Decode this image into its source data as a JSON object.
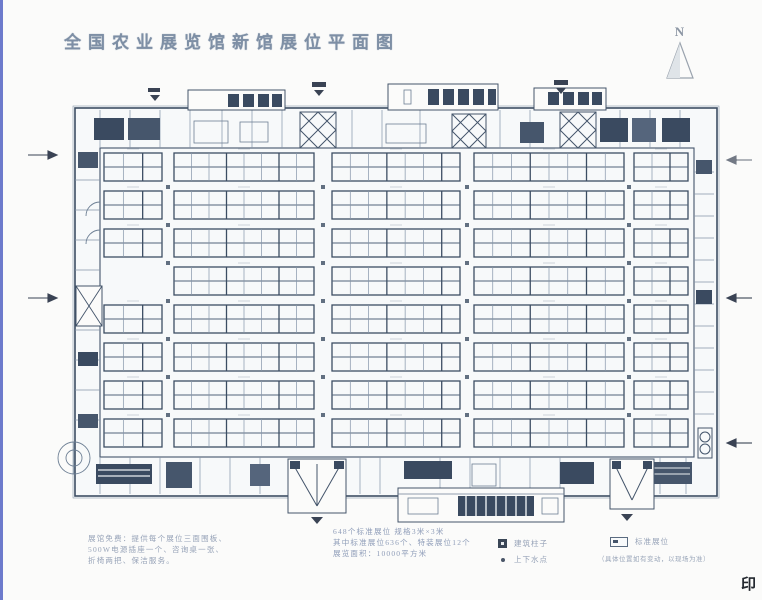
{
  "title": "全国农业展览馆新馆展位平面图",
  "compass": {
    "label": "N"
  },
  "stamp": "印",
  "notes_left": {
    "lines": [
      "展馆免费：提供每个展位三面围板、",
      "500W电源插座一个、咨询桌一张、",
      "折椅两把、保洁服务。"
    ]
  },
  "notes_center": {
    "lines": [
      "648个标准展位 规格3米×3米",
      "其中标准展位636个、特装展位12个",
      "展览面积：10000平方米"
    ]
  },
  "legend": {
    "items": [
      {
        "icon": "column-icon",
        "label": "建筑柱子"
      },
      {
        "icon": "water-point-icon",
        "label": "上下水点"
      },
      {
        "icon": "booth-icon",
        "label": "标准展位"
      },
      {
        "icon": "",
        "label": "（具体位置如有变动，以现场为准）"
      }
    ]
  },
  "colors": {
    "paper": "#fbfbfa",
    "plan_bg": "#f7f9fa",
    "ink_dark": "#3c4d63",
    "ink": "#52647a",
    "ink_light": "#8494a8",
    "tick": "#c3cbd4",
    "fill_dark": "#3a4a60",
    "arrow": "#3a4354",
    "edge_blue": "#4a5bc0"
  },
  "plan": {
    "band_h": 28,
    "bands_y": [
      153,
      191,
      229,
      267,
      305,
      343,
      381,
      419
    ],
    "blocks": [
      {
        "x": 104,
        "w": 58,
        "cols": 3
      },
      {
        "x": 174,
        "w": 140,
        "cols": 8
      },
      {
        "x": 332,
        "w": 128,
        "cols": 7
      },
      {
        "x": 474,
        "w": 150,
        "cols": 8
      },
      {
        "x": 634,
        "w": 54,
        "cols": 3
      }
    ],
    "skip_blocks": [
      [
        3,
        0
      ]
    ],
    "columns_x": [
      168,
      323,
      467,
      629
    ],
    "columns_y": [
      187,
      225,
      263,
      301,
      339,
      377,
      415
    ]
  }
}
